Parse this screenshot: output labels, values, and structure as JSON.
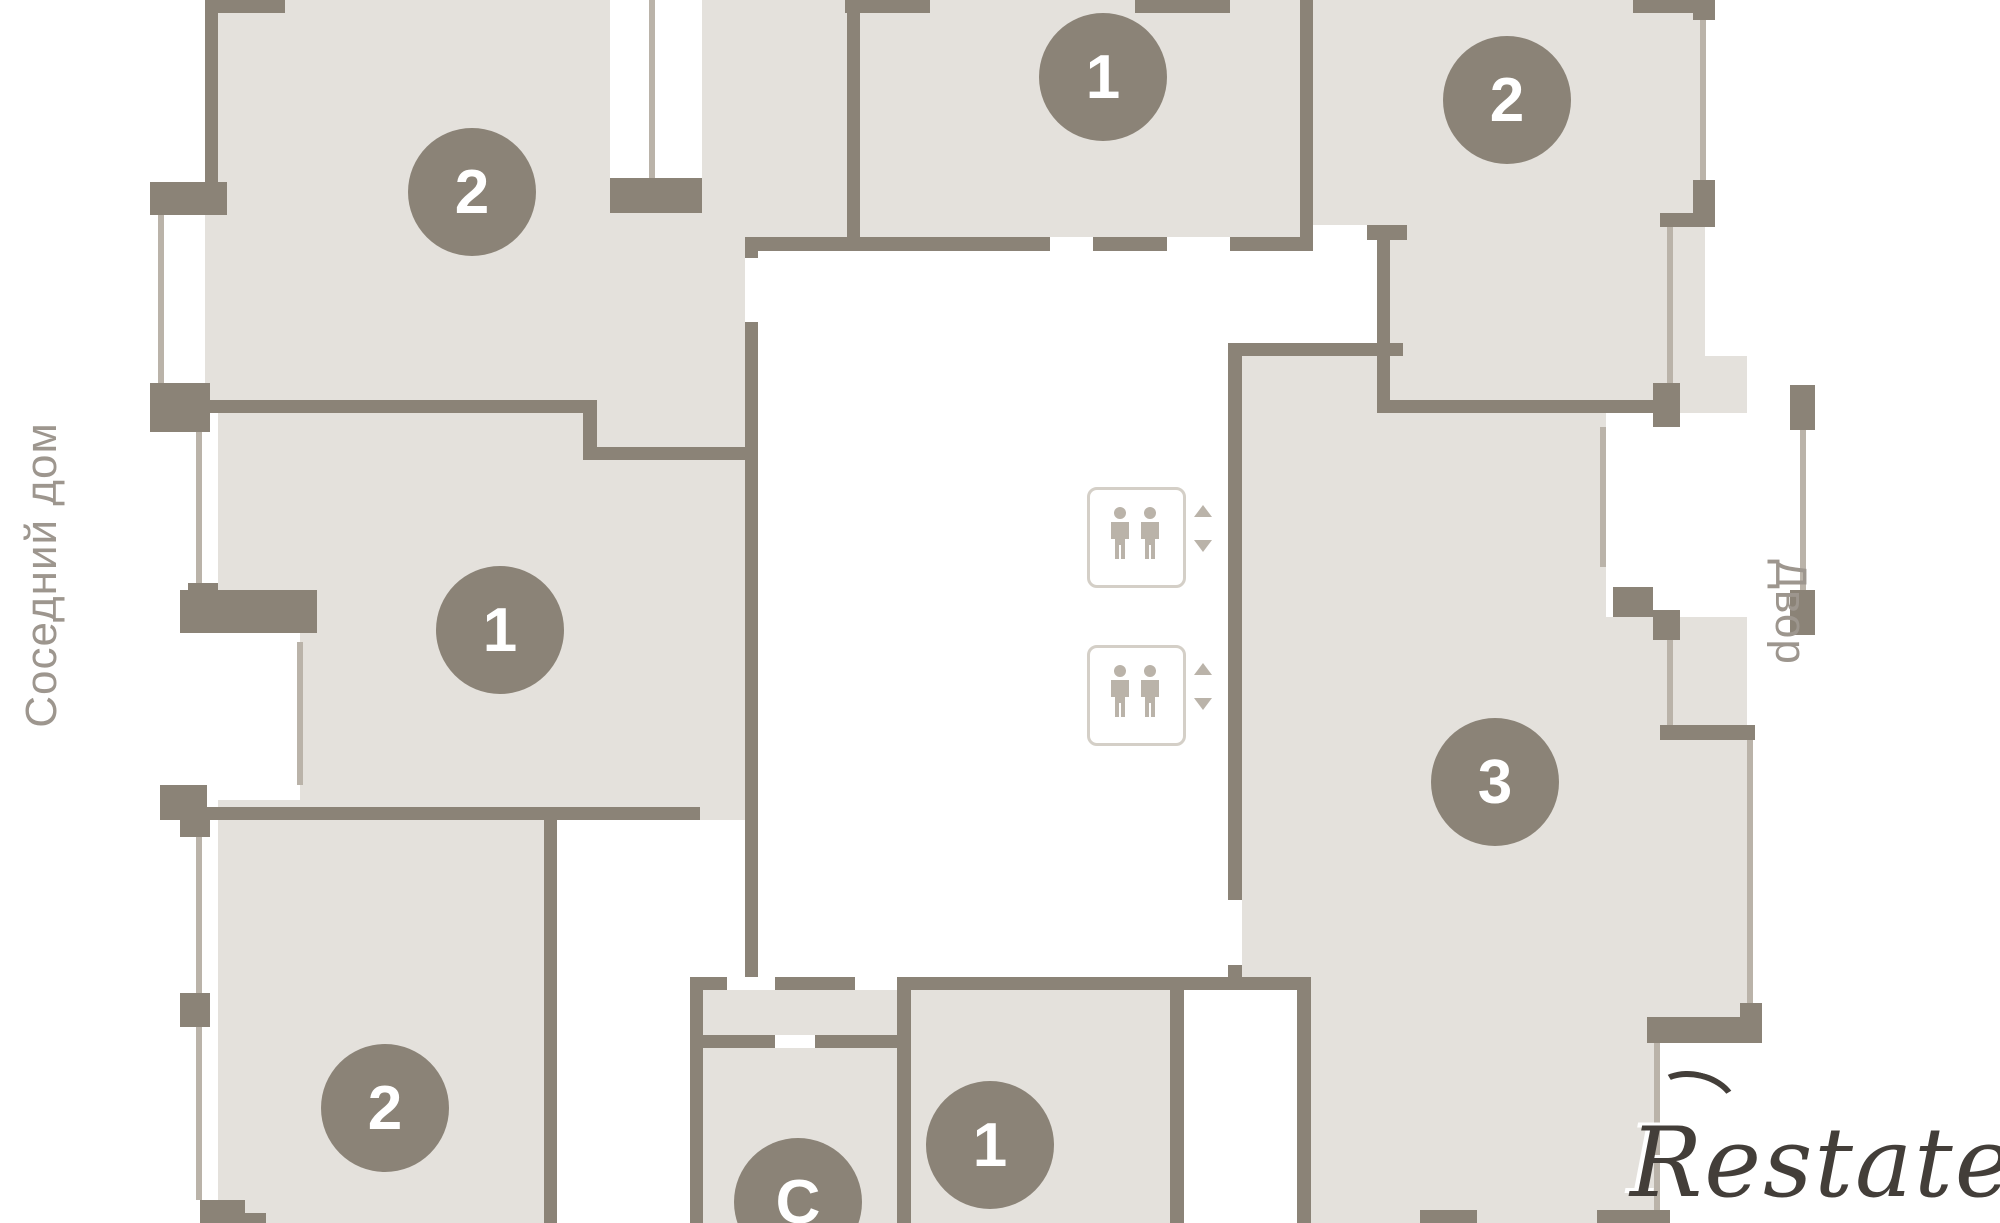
{
  "floorplan": {
    "side_labels": {
      "left": "Соседний дом",
      "right": "Двор"
    },
    "watermark": "Restate",
    "apartments": [
      {
        "id": "top-left",
        "rooms": "2"
      },
      {
        "id": "top-center",
        "rooms": "1"
      },
      {
        "id": "top-right",
        "rooms": "2"
      },
      {
        "id": "mid-left",
        "rooms": "1"
      },
      {
        "id": "right-large",
        "rooms": "3"
      },
      {
        "id": "bottom-left",
        "rooms": "2"
      },
      {
        "id": "bottom-studio",
        "rooms": "С"
      },
      {
        "id": "bottom-center",
        "rooms": "1"
      }
    ],
    "elevators": {
      "count": 2,
      "icon": "elevator-passengers-icon",
      "arrows": [
        "up",
        "down"
      ]
    },
    "colors": {
      "wall": "#8b8377",
      "room_fill": "#e4e1dc",
      "window": "#bab3a9",
      "badge": "#8b8377",
      "label_text": "#9d968e",
      "watermark_text": "#433e39"
    }
  }
}
